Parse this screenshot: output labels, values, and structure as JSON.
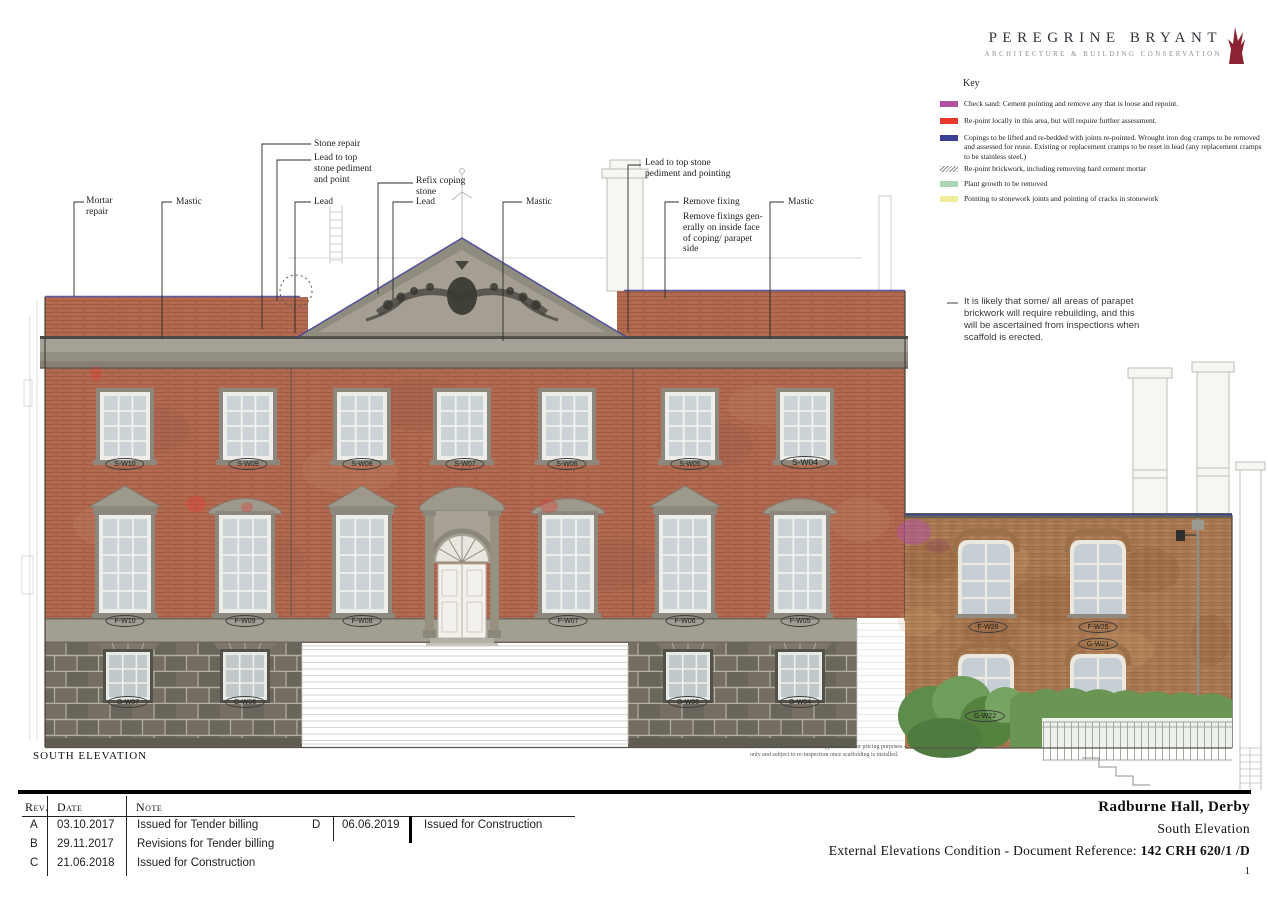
{
  "logo": {
    "title": "PEREGRINE BRYANT",
    "subtitle": "ARCHITECTURE & BUILDING CONSERVATION",
    "mark_color": "#8c2332"
  },
  "key": {
    "title": "Key",
    "items": [
      {
        "name": "check-sand",
        "color": "#b352a5",
        "text": "Check sand: Cement pointing and remove any that is loose and repoint."
      },
      {
        "name": "repoint-locally",
        "color": "#e8392e",
        "text": "Re-point locally in this area, but will require further assessment."
      },
      {
        "name": "copings",
        "color": "#3b3f96",
        "text": "Copings to be lifted and re-bedded with joints re-pointed. Wrought iron dog cramps to be removed and assessed for reuse. Existing or replacement cramps to be reset in lead (any replacement cramps to be stainless steel.)"
      },
      {
        "name": "repoint-brickwork",
        "color": "#9a9a9a",
        "text": "Re-point brickwork, including removing hard cement mortar"
      },
      {
        "name": "plant-growth",
        "color": "#a9d5b5",
        "text": "Plant growth to be removed"
      },
      {
        "name": "pointing-stonework",
        "color": "#f0ee9b",
        "text": "Pointing to stonework joints and pointing of cracks in stonework"
      }
    ]
  },
  "annotations": {
    "mortar_repair": "Mortar\nrepair",
    "mastic_left": "Mastic",
    "stone_repair": "Stone repair",
    "lead_top_left": "Lead to top\nstone pediment\nand point",
    "lead_left": "Lead",
    "refix_coping": "Refix coping\nstone",
    "lead_right": "Lead",
    "mastic_center": "Mastic",
    "lead_top_right": "Lead to top stone\npediment and pointing",
    "remove_fixing": "Remove fixing",
    "remove_fixings_note": "Remove fixings gen-\nerally on inside face\nof coping/ parapet\nside",
    "mastic_right": "Mastic",
    "parapet_note": "It is likely that some/ all areas of parapet\nbrickwork will require rebuilding, and this\nwill be ascertained from inspections when\nscaffold is erected."
  },
  "window_labels": {
    "second_floor": [
      "S-W10",
      "S-W09",
      "S-W08",
      "S-W07",
      "S-W06",
      "S-W05",
      "S-W04"
    ],
    "first_floor": [
      "F-W10",
      "F-W09",
      "F-W08",
      "F-W07",
      "F-W06",
      "F-W05"
    ],
    "ground_floor": [
      "G-W07",
      "G-W06",
      "G-W05",
      "G-W04"
    ],
    "wing": [
      "F-W26",
      "F-W25",
      "G-W21",
      "G-W22"
    ]
  },
  "drawing_label": "SOUTH ELEVATION",
  "location_note_line1": "Note: Locations are shown as approximate for pricing purposes",
  "location_note_line2": "only and subject to re-inspection once scaffolding is installed.",
  "revisions": {
    "headers": {
      "rev": "Rev.",
      "date": "Date",
      "note": "Note"
    },
    "rows": [
      {
        "rev": "A",
        "date": "03.10.2017",
        "note": "Issued for Tender billing"
      },
      {
        "rev": "B",
        "date": "29.11.2017",
        "note": "Revisions for Tender billing"
      },
      {
        "rev": "C",
        "date": "21.06.2018",
        "note": "Issued for Construction"
      },
      {
        "rev": "D",
        "date": "06.06.2019",
        "note": "Issued for Construction"
      }
    ]
  },
  "title_block": {
    "project": "Radburne Hall, Derby",
    "drawing_title": "South Elevation",
    "reference_prefix": "External Elevations Condition - Document Reference: ",
    "reference": "142 CRH 620/1 /D",
    "page": "1"
  }
}
